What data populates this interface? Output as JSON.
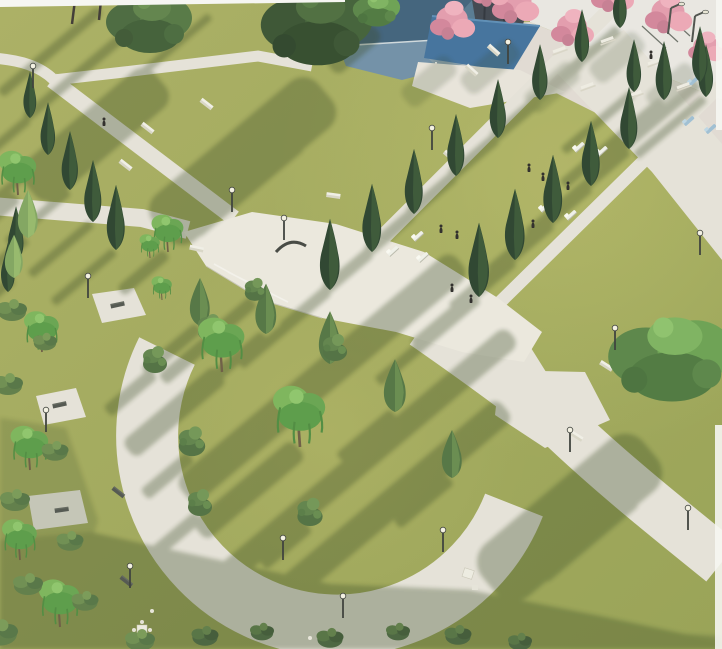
{
  "scene": {
    "type": "3D architectural landscape render (scanned visualization)",
    "view": "aerial bird's-eye view of a public park",
    "lighting": "low sun from the upper right casting long parallel shadows toward the lower left",
    "visible_text": [],
    "alt_text": "Aerial rendering of a landscaped park: a circular lawn enclosed by a wide paved ring path, a central paved plaza, diagonal promenades lined with dark conical cypress trees, open lawns with white lounge chairs and small human figures, benches and lampposts along paths, and at the top blue-roofed buildings, a columned pavilion and pink flowering trees shading picnic tables on a terrace.",
    "areas": {
      "top_edge": "white buildings with blue hip roofs, dark slatted building, columned pavilion, terrace with picnic tables under pink blossom trees",
      "upper_right": "long diagonal lawn strip between two cypress-lined walks, scattered loungers and people, tilted modern street lamps near terrace steps",
      "center": "irregular stepped plaza with a dark curved sculptural bench and lamps",
      "lower_left": "large circular lawn with round conifer bushes and two bright weeping trees, surrounded by a wide ring path with bench alcoves, chess table and lamps; rough shrubs along the left edge",
      "lower_right": "wide promenade crossing at an X intersection, large canopy tree, lampposts, deep shadow across the bottom"
    },
    "palette": {
      "lawn_sunlit": "#a5aa5b",
      "lawn_shadow": "#6e7a43",
      "path": "#e5e2d7",
      "plaza": "#ebe8dd",
      "cypress_dark": "#27402a",
      "conifer_medium": "#50723f",
      "weeping_bright": "#65a34c",
      "big_canopy": "#47673a",
      "pink_blossom": "#e39aab",
      "roof_blue_dark": "#3d5f79",
      "roof_blue_light": "#6e8ea5",
      "pavilion_roof": "#3f6f9a",
      "shadow_tint": "#31451f",
      "bench_white": "#f1f0e6",
      "lamp_metal": "#383c36"
    },
    "object_counts": {
      "cypress_trees": 24,
      "medium_conifer_cones": 7,
      "round_bushes": 7,
      "weeping_and_small_trees": 10,
      "large_canopy_trees": 4,
      "pink_blossom_trees": 7,
      "shrub_clusters": 16,
      "lampposts": 17,
      "white_benches": 10,
      "dark_benches": 5,
      "loungers": 10,
      "picnic_tables": 7,
      "chess_table": 1,
      "people": 10
    }
  }
}
